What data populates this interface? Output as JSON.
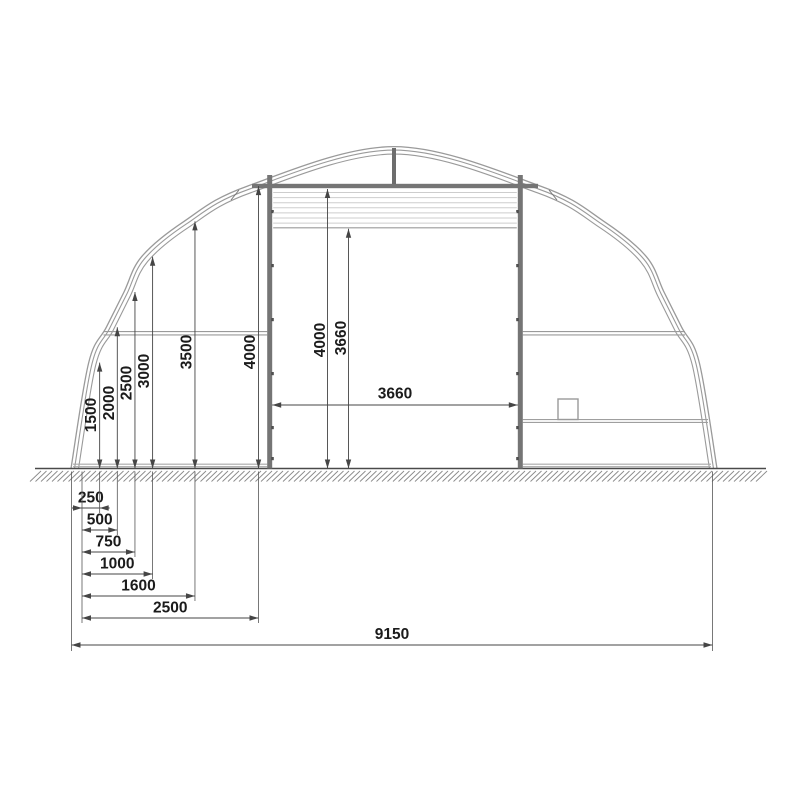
{
  "meta": {
    "drawing_type": "arched-building-cross-section",
    "colors": {
      "dim_line": "#454545",
      "text": "#1b1b1b",
      "arch": "#9a9a9a",
      "structure_dark": "#757575",
      "structure_light": "#a8a8a8",
      "slat": "#cdcdcd",
      "ground": "#4a4a4a",
      "hatch": "#8a8a8a"
    }
  },
  "drawing": {
    "total_width": {
      "label": "9150",
      "mm": 9150
    },
    "apex_height_mm": 4560,
    "height_profile": [
      {
        "offset_label": "250",
        "offset_mm": 250,
        "height_label": "1500",
        "height_mm": 1500
      },
      {
        "offset_label": "500",
        "offset_mm": 500,
        "height_label": "2000",
        "height_mm": 2000
      },
      {
        "offset_label": "750",
        "offset_mm": 750,
        "height_label": "2500",
        "height_mm": 2500
      },
      {
        "offset_label": "1000",
        "offset_mm": 1000,
        "height_label": "3000",
        "height_mm": 3000
      },
      {
        "offset_label": "1600",
        "offset_mm": 1600,
        "height_label": "3500",
        "height_mm": 3500
      },
      {
        "offset_label": "2500",
        "offset_mm": 2500,
        "height_label": "4000",
        "height_mm": 4000
      }
    ],
    "door": {
      "width_label": "3660",
      "clear_height_label": "3660",
      "header_height_label": "4000",
      "header_height_mm": 4000
    }
  }
}
